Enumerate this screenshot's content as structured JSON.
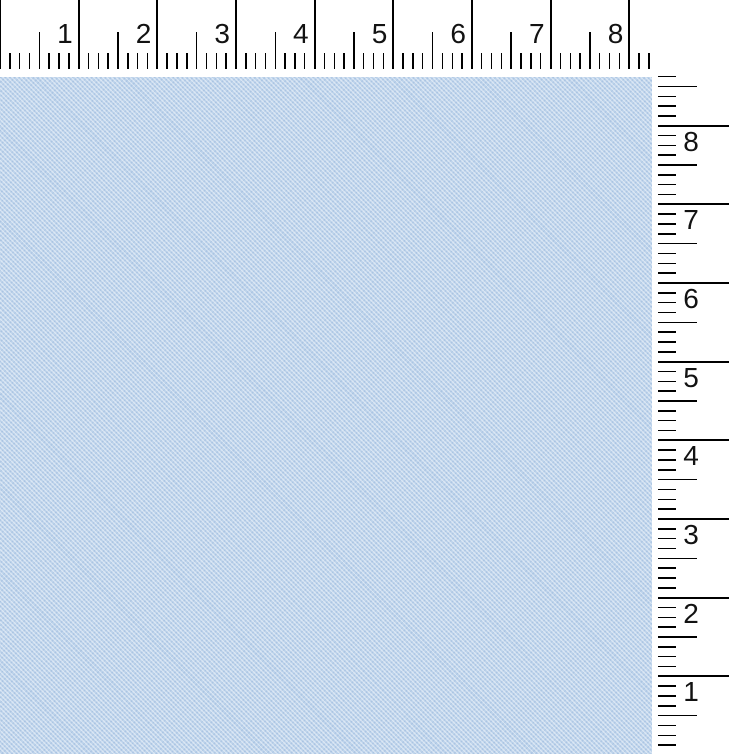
{
  "window": {
    "width": 729,
    "height": 754,
    "background_color": "#ffffff"
  },
  "canvas": {
    "kind": "fabric-swatch-preview",
    "base_color": "#bdd3eb",
    "weave_light_color": "#c9dcf1",
    "weave_dark_color": "#b4cde8",
    "x": 0,
    "y": 77,
    "width": 652,
    "height": 677
  },
  "rulers": {
    "tick_color": "#000000",
    "number_color": "#121212",
    "pixels_per_unit": 78.66,
    "divisions_per_unit": 8,
    "horizontal": {
      "x": 0,
      "y": 0,
      "width": 655,
      "height": 69,
      "first_tick_index": 0,
      "last_tick_index": 66,
      "long_tick": {
        "top": 0,
        "length": 69,
        "thickness": 2
      },
      "medium_tick": {
        "top": 32,
        "length": 37,
        "thickness": 1.6
      },
      "short_tick": {
        "top": 53,
        "length": 16,
        "thickness": 1.4
      },
      "numbers": [
        "1",
        "2",
        "3",
        "4",
        "5",
        "6",
        "7",
        "8"
      ],
      "number_top": 20,
      "number_gap_right_of_text_to_tick": 6
    },
    "vertical": {
      "x": 658,
      "y_top": 70,
      "width": 71,
      "height_to": 754,
      "value_8_y": 125.7,
      "start_value_eighths": 69,
      "end_value_eighths": 1,
      "long_tick": {
        "left": 658,
        "length": 71,
        "thickness": 2
      },
      "medium_tick": {
        "left": 658,
        "length": 39,
        "thickness": 1.6
      },
      "short_tick": {
        "left": 658,
        "length": 18,
        "thickness": 1.4
      },
      "numbers": [
        "8",
        "7",
        "6",
        "5",
        "4",
        "3",
        "2",
        "1"
      ],
      "number_left": 678,
      "number_offset_below_line": 2
    }
  }
}
